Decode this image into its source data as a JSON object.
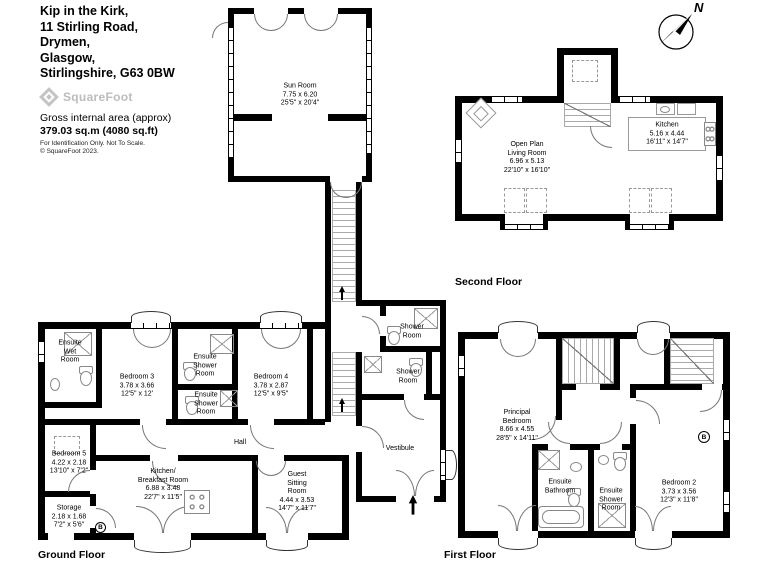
{
  "header": {
    "address_lines": [
      "Kip in the Kirk,",
      "11 Stirling Road,",
      "Drymen,",
      "Glasgow,",
      "Stirlingshire, G63 0BW"
    ],
    "brand": "SquareFoot",
    "area_label": "Gross internal area (approx)",
    "area_value": "379.03 sq.m (4080 sq.ft)",
    "note_line1": "For Identification Only. Not To Scale.",
    "note_line2": "© SquareFoot 2023."
  },
  "compass": {
    "north_label": "N"
  },
  "floor_labels": {
    "ground": "Ground Floor",
    "first": "First Floor",
    "second": "Second Floor"
  },
  "rooms": {
    "sun_room": {
      "name": "Sun Room",
      "metric": "7.75 x 6.20",
      "imperial": "25'5\" x 20'4\""
    },
    "open_plan_living_room": {
      "name": "Open Plan\nLiving Room",
      "metric": "6.96 x 5.13",
      "imperial": "22'10\" x 16'10\""
    },
    "kitchen": {
      "name": "Kitchen",
      "metric": "5.16 x 4.44",
      "imperial": "16'11\" x 14'7\""
    },
    "ensuite_wet_room": {
      "name": "Ensuite\nWet\nRoom"
    },
    "bedroom_3": {
      "name": "Bedroom 3",
      "metric": "3.78 x 3.66",
      "imperial": "12'5\" x 12'"
    },
    "ensuite_shower_room_a": {
      "name": "Ensuite\nShower\nRoom"
    },
    "ensuite_shower_room_b": {
      "name": "Ensuite\nShower\nRoom"
    },
    "bedroom_4": {
      "name": "Bedroom 4",
      "metric": "3.78 x 2.87",
      "imperial": "12'5\" x 9'5\""
    },
    "shower_room_a": {
      "name": "Shower\nRoom"
    },
    "shower_room_b": {
      "name": "Shower\nRoom"
    },
    "hall": {
      "name": "Hall"
    },
    "vestibule": {
      "name": "Vestibule"
    },
    "bedroom_5": {
      "name": "Bedroom 5",
      "metric": "4.22 x 2.18",
      "imperial": "13'10\" x 7'2\""
    },
    "storage": {
      "name": "Storage",
      "metric": "2.18 x 1.68",
      "imperial": "7'2\" x 5'6\""
    },
    "kitchen_breakfast_room": {
      "name": "Kitchen/\nBreakfast Room",
      "metric": "6.88 x 3.48",
      "imperial": "22'7\" x 11'5\""
    },
    "guest_sitting_room": {
      "name": "Guest\nSitting\nRoom",
      "metric": "4.44 x 3.53",
      "imperial": "14'7\" x 11'7\""
    },
    "principal_bedroom": {
      "name": "Principal\nBedroom",
      "metric": "8.66 x 4.55",
      "imperial": "28'5\" x 14'11\""
    },
    "ensuite_bathroom": {
      "name": "Ensuite\nBathroom"
    },
    "ensuite_shower_room_c": {
      "name": "Ensuite\nShower\nRoom"
    },
    "bedroom_2": {
      "name": "Bedroom 2",
      "metric": "3.73 x 3.56",
      "imperial": "12'3\" x 11'8\""
    },
    "boiler": {
      "label": "B"
    }
  }
}
